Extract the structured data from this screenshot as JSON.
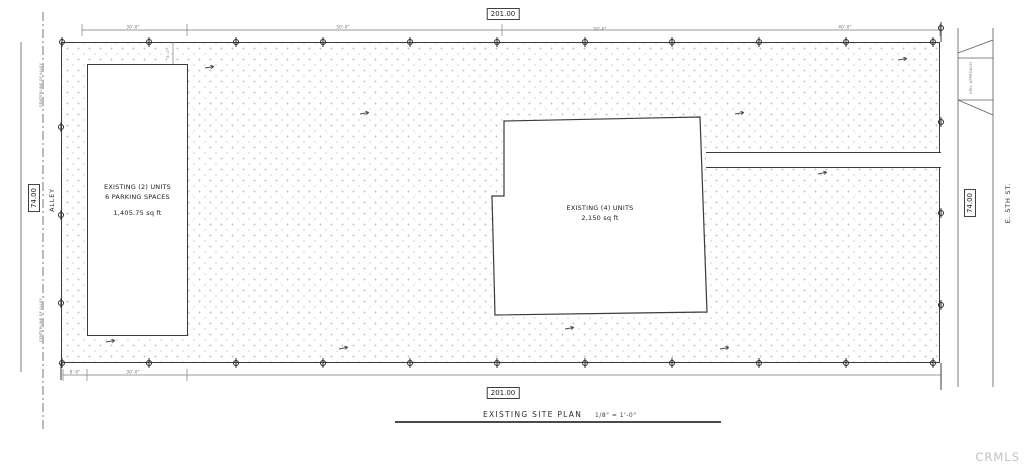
{
  "plan": {
    "title": "EXISTING SITE PLAN",
    "scale": "1/8\" = 1'-0\"",
    "watermark": "CRMLS"
  },
  "dimensions": {
    "top_overall": "201.00",
    "bottom_overall": "201.00",
    "left_overall": "74.00",
    "right_overall": "74.00",
    "top_segments": [
      "30'-0\"",
      "50'-0\"",
      "50'-0\"",
      "40'-0\""
    ],
    "bottom_segments": [
      "8'-0\"",
      "30'-0\""
    ],
    "front_setback": "5'-0\""
  },
  "labels": {
    "alley": "ALLEY",
    "alley_centerline_upper": "CENTERLINE OF ALLEY",
    "alley_centerline_lower": "CENTERLINE OF ALLEY",
    "street": "E. 5TH ST.",
    "driveway_approach": "VEH. APPROACH"
  },
  "buildings": {
    "left": {
      "name": "EXISTING (2) UNITS",
      "parking": "6 PARKING SPACES",
      "area": "1,405.75 sq ft"
    },
    "main": {
      "name": "EXISTING (4) UNITS",
      "area": "2,150 sq ft"
    }
  },
  "colors": {
    "line": "#3a3a3a",
    "dim_line": "#6a6a6a",
    "watermark": "#c2c2c2"
  }
}
